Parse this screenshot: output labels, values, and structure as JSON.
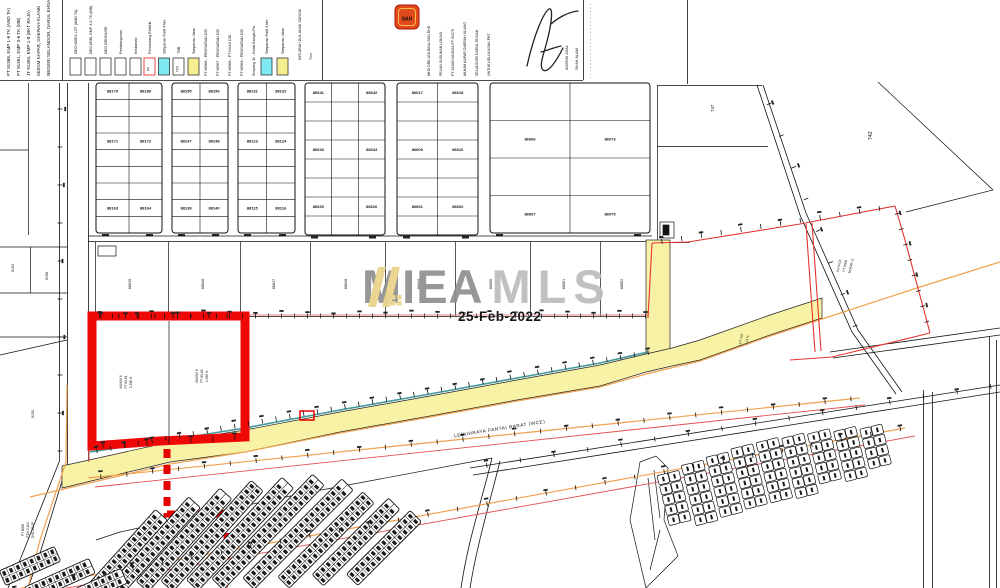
{
  "watermark": {
    "brand_primary": "MIEA",
    "brand_secondary": "MLS",
    "date": "25-Feb-2022",
    "logo_icon": "roof-slashes-icon"
  },
  "header": {
    "left_title_lines": [
      "PT 91368, EMP 1-6 TK (AND TA)",
      "PT 91361, EMP 3-6 TK (MB)",
      "JT 91360, EMP 1-8 (BKT RAJA)",
      "MUKIM KAPAR, DAERAH KLANG",
      "NEGERI SELANGOR, DARUL EHSAN"
    ],
    "legend": {
      "captions": [
        "DEG+AREL LOT (AND TA)",
        "DEG AREL EMP 3-6 TK (MB)",
        "DEG DRHOUSE",
        "Pembangunan",
        "Kediaman",
        "Pencawang Elektrik",
        "Simpanan Parit 4 Me.",
        "TNB",
        "Simpanan Jalan"
      ],
      "middle_captions": [
        "PT 66566 - PENGAIRAN DID",
        "PT 66567 - PENGAIRAN DID",
        "PT 66568 - PT KHAS DID",
        "PT 66569 - PENGAIRAN DID",
        "Simpang 11 - Kedai Bangku Pa."
      ],
      "right_captions": [
        "Simpanan Parit 4 Me.",
        "Simpanan Jalan"
      ],
      "extra_captions": [
        "KIRI ARAH DUL ANAK SUNGAI",
        "Tmn."
      ],
      "pe_box_label": "PK",
      "tcx_box_label": "TKX"
    },
    "stamp_label": "SAH",
    "notes_lines": [
      "MHD DRE AYA BINA SDN BHD",
      "PELAN SUSUNAN LOKASI",
      "PT 91368 HINGGA PT 91375",
      "MUKIM KAPAR DAERAH KLANG",
      "SELANGOR DARUL EHSAN",
      "UNTUK KELULUSAN PBT"
    ],
    "agency_lines": [
      "AGENSI ASAL",
      "SHAH ALAM"
    ]
  },
  "map": {
    "road_label": "LEBUHRAYA PANTAI BARAT (WCE)",
    "parcel_row_labels": [
      "86645",
      "86646",
      "86647",
      "86648",
      "86649",
      "86650",
      "86651",
      "86652"
    ],
    "grid_numbers": {
      "b1": [
        [
          "88179",
          "88180"
        ],
        [
          "88171",
          "88172"
        ],
        [
          "88163",
          "88164"
        ]
      ],
      "b2": [
        [
          "88155",
          "88156"
        ],
        [
          "88147",
          "88148"
        ],
        [
          "88139",
          "88140"
        ]
      ],
      "b3": [
        [
          "88131",
          "88132"
        ],
        [
          "88123",
          "88124"
        ],
        [
          "88115",
          "88116"
        ]
      ],
      "b4": [
        [
          "86641",
          "86642"
        ],
        [
          "86633",
          "86634"
        ],
        [
          "86625",
          "86626"
        ]
      ],
      "b5": [
        [
          "86617",
          "86618"
        ],
        [
          "86609",
          "86610"
        ],
        [
          "86601",
          "86602"
        ]
      ],
      "b6": [
        [
          "86066",
          "86073"
        ],
        [
          "86067",
          "86075"
        ]
      ]
    },
    "red_plot": {
      "left_label_lines": [
        "MUKIM 6",
        "PT 69-61",
        "1.338 H."
      ],
      "right_label_lines": [
        "MUKIM 6",
        "PT 69-62",
        "1.338 H."
      ]
    },
    "left_labels": {
      "a": "9156",
      "b": "9154",
      "c": "9152"
    },
    "pt8008_lines": [
      "PT 8008",
      "PZM 5,114",
      "2HA-1R-0P"
    ],
    "right_labels": {
      "lot742": "742",
      "lot747": "747",
      "east_label_lines": [
        "CH WCE",
        "PT 8008",
        "MUKIM 12"
      ],
      "south_label_lines": [
        "LOT 742",
        "1.21 H."
      ]
    }
  }
}
